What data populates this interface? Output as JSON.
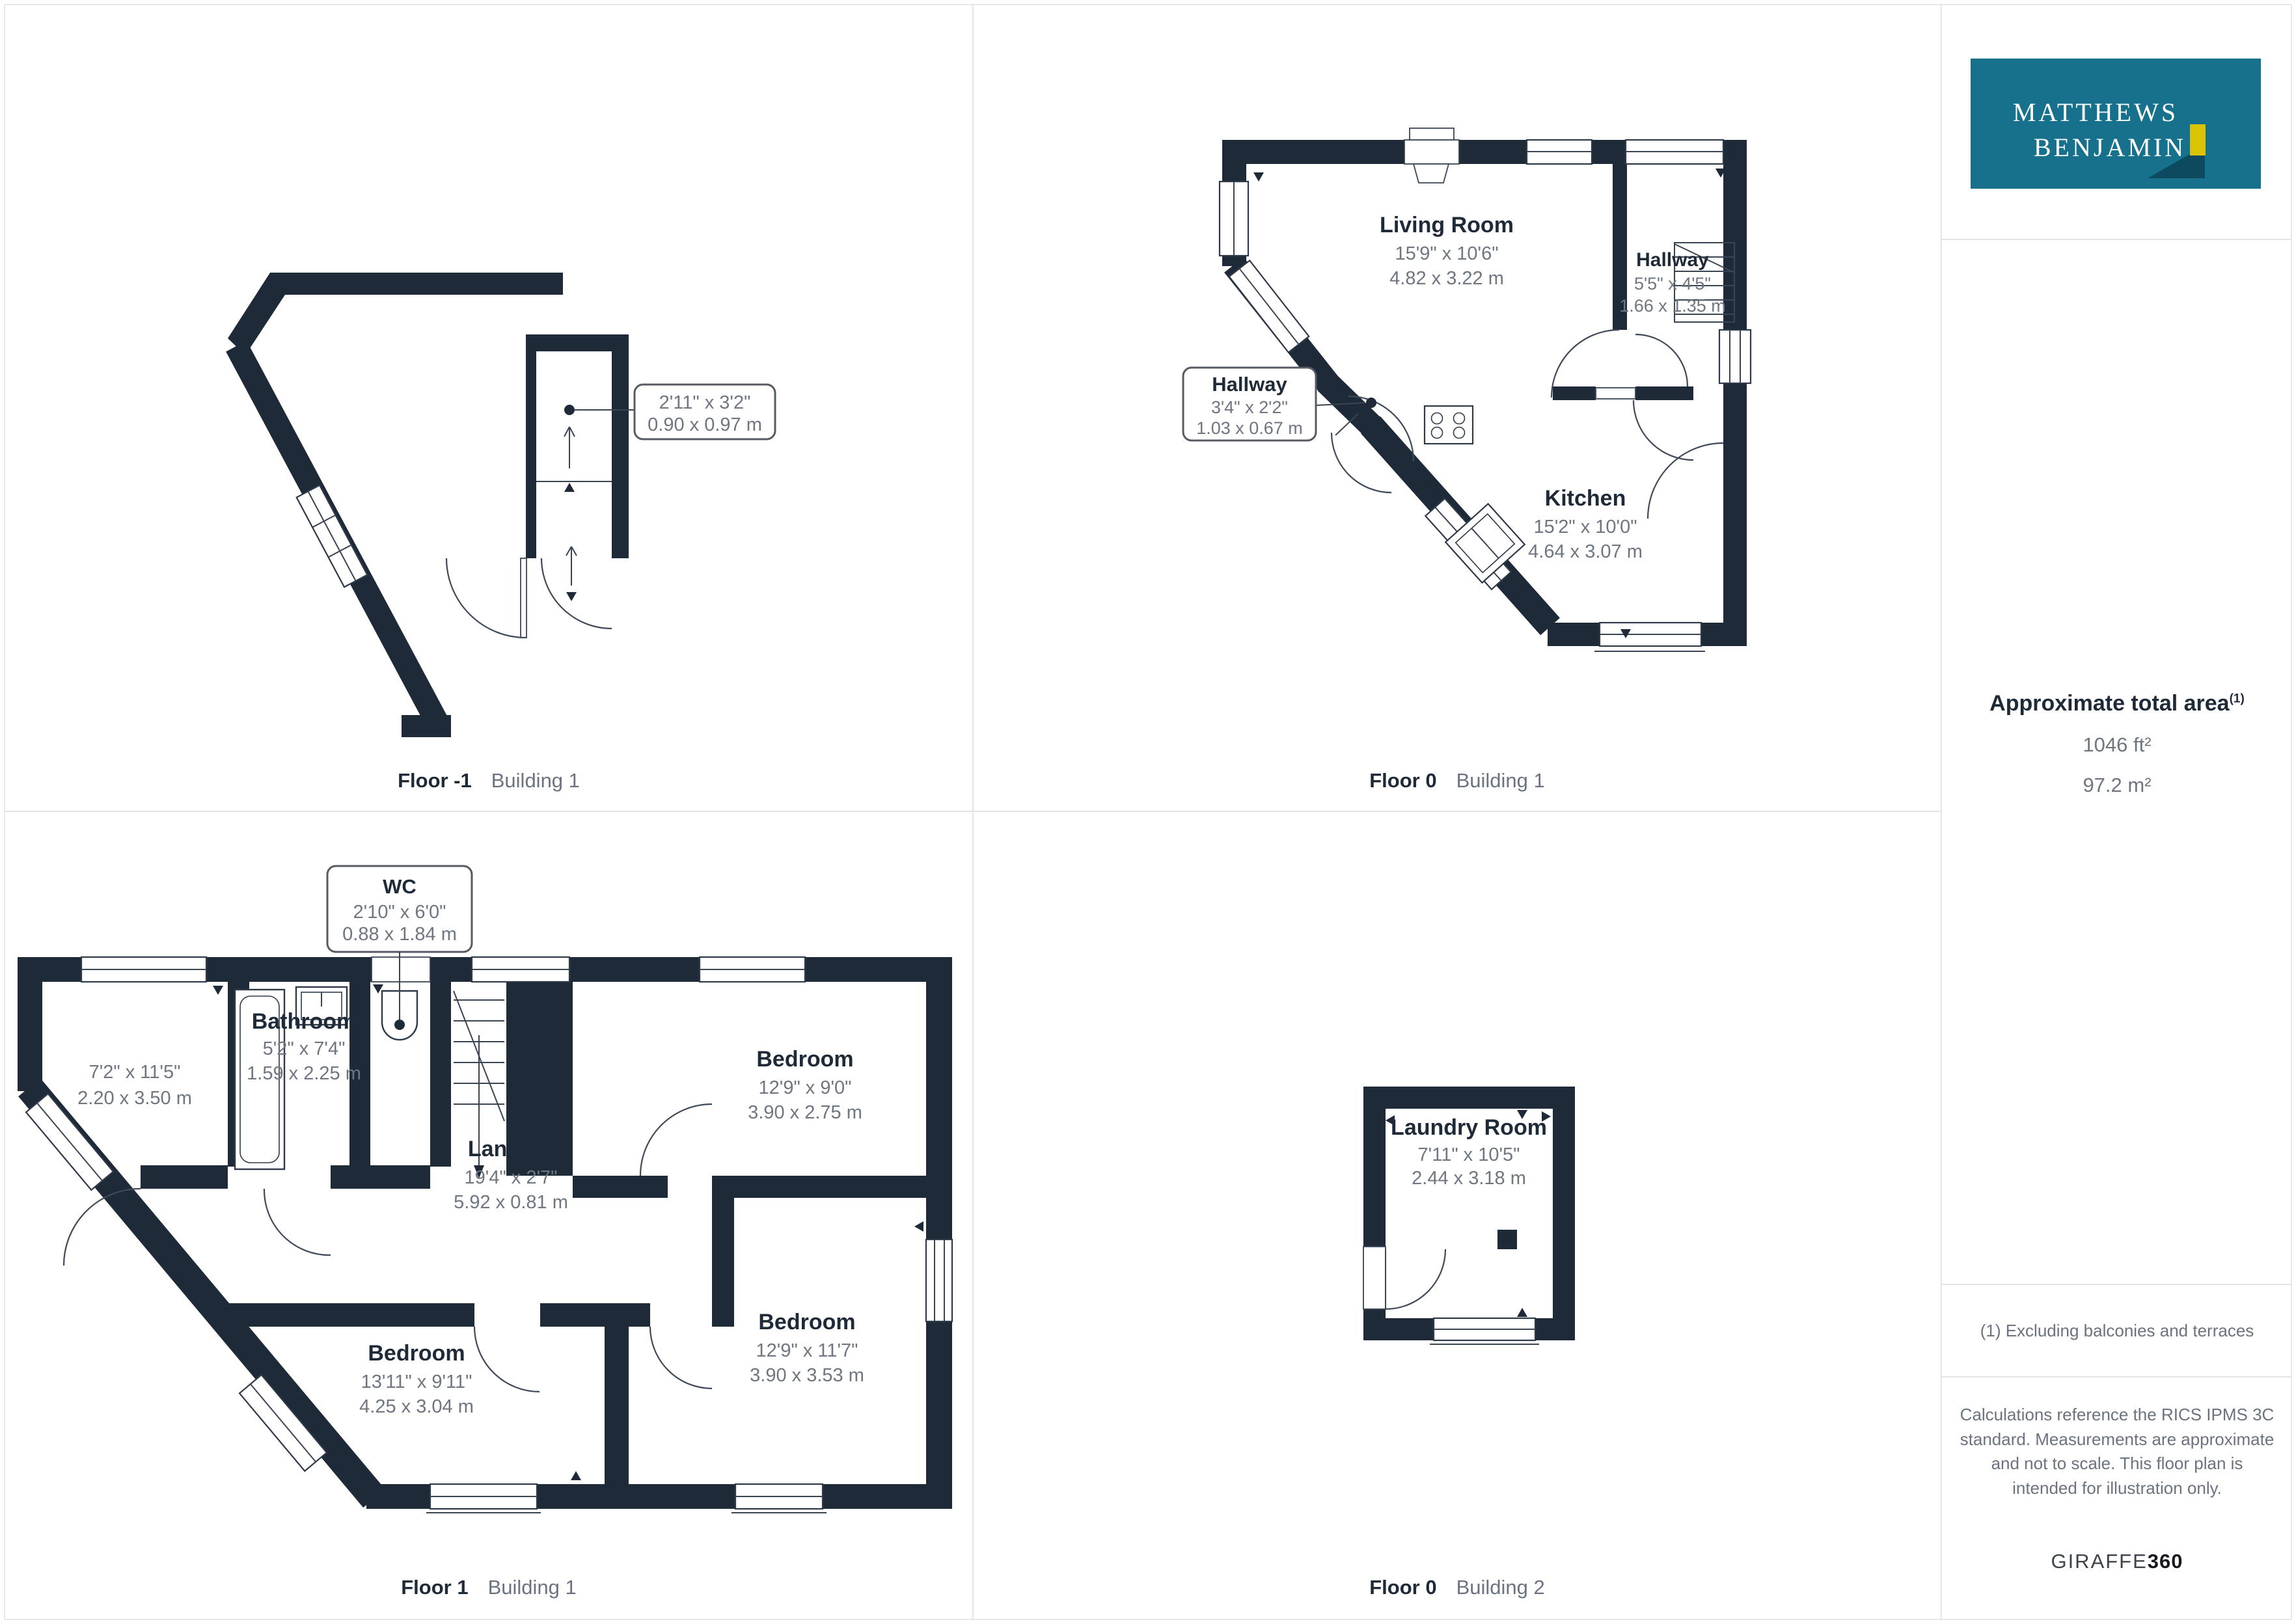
{
  "branding": {
    "line1": "MATTHEWS",
    "line2": "BENJAMIN"
  },
  "colors": {
    "wall": "#1f2a38",
    "logo_teal": "#17718c",
    "logo_yellow": "#d9c303",
    "logo_shadow": "#0d4a5f",
    "dims_gray": "#6e7681",
    "divider": "#e3e4e6"
  },
  "captions": [
    {
      "floor": "Floor -1",
      "building": "Building 1"
    },
    {
      "floor": "Floor 0",
      "building": "Building 1"
    },
    {
      "floor": "Floor 1",
      "building": "Building 1"
    },
    {
      "floor": "Floor 0",
      "building": "Building 2"
    }
  ],
  "floor_minus1": {
    "callout_ft": "2'11\" x 3'2\"",
    "callout_m": "0.90 x 0.97 m"
  },
  "floor0_b1": {
    "living": {
      "name": "Living Room",
      "ft": "15'9\" x 10'6\"",
      "m": "4.82 x 3.22 m"
    },
    "hallway": {
      "name": "Hallway",
      "ft": "5'5\" x 4'5\"",
      "m": "1.66 x 1.35 m"
    },
    "hallway_callout": {
      "name": "Hallway",
      "ft": "3'4\" x 2'2\"",
      "m": "1.03 x 0.67 m"
    },
    "kitchen": {
      "name": "Kitchen",
      "ft": "15'2\" x 10'0\"",
      "m": "4.64 x 3.07 m"
    }
  },
  "floor1_b1": {
    "wc": {
      "name": "WC",
      "ft": "2'10\" x 6'0\"",
      "m": "0.88 x 1.84 m"
    },
    "bathroom": {
      "name": "Bathroom",
      "ft": "5'2\" x 7'4\"",
      "m": "1.59 x 2.25 m"
    },
    "room": {
      "ft": "7'2\" x 11'5\"",
      "m": "2.20 x 3.50 m"
    },
    "bedroom_top": {
      "name": "Bedroom",
      "ft": "12'9\" x 9'0\"",
      "m": "3.90 x 2.75 m"
    },
    "landing": {
      "name": "Landing",
      "ft": "19'4\" x 2'7\"",
      "m": "5.92 x 0.81 m"
    },
    "bedroom_left": {
      "name": "Bedroom",
      "ft": "13'11\" x 9'11\"",
      "m": "4.25 x 3.04 m"
    },
    "bedroom_right": {
      "name": "Bedroom",
      "ft": "12'9\" x 11'7\"",
      "m": "3.90 x 3.53 m"
    }
  },
  "floor0_b2": {
    "laundry": {
      "name": "Laundry Room",
      "ft": "7'11\" x 10'5\"",
      "m": "2.44 x 3.18 m"
    }
  },
  "sidebar": {
    "area_title": "Approximate total area",
    "area_sup": "(1)",
    "area_ft": "1046 ft²",
    "area_m": "97.2 m²",
    "footnote": "(1) Excluding balconies and terraces",
    "disclaimer": "Calculations reference the RICS IPMS 3C standard. Measurements are approximate and not to scale. This floor plan is intended for illustration only.",
    "brand": "GIRAFFE",
    "brand_bold": "360"
  }
}
